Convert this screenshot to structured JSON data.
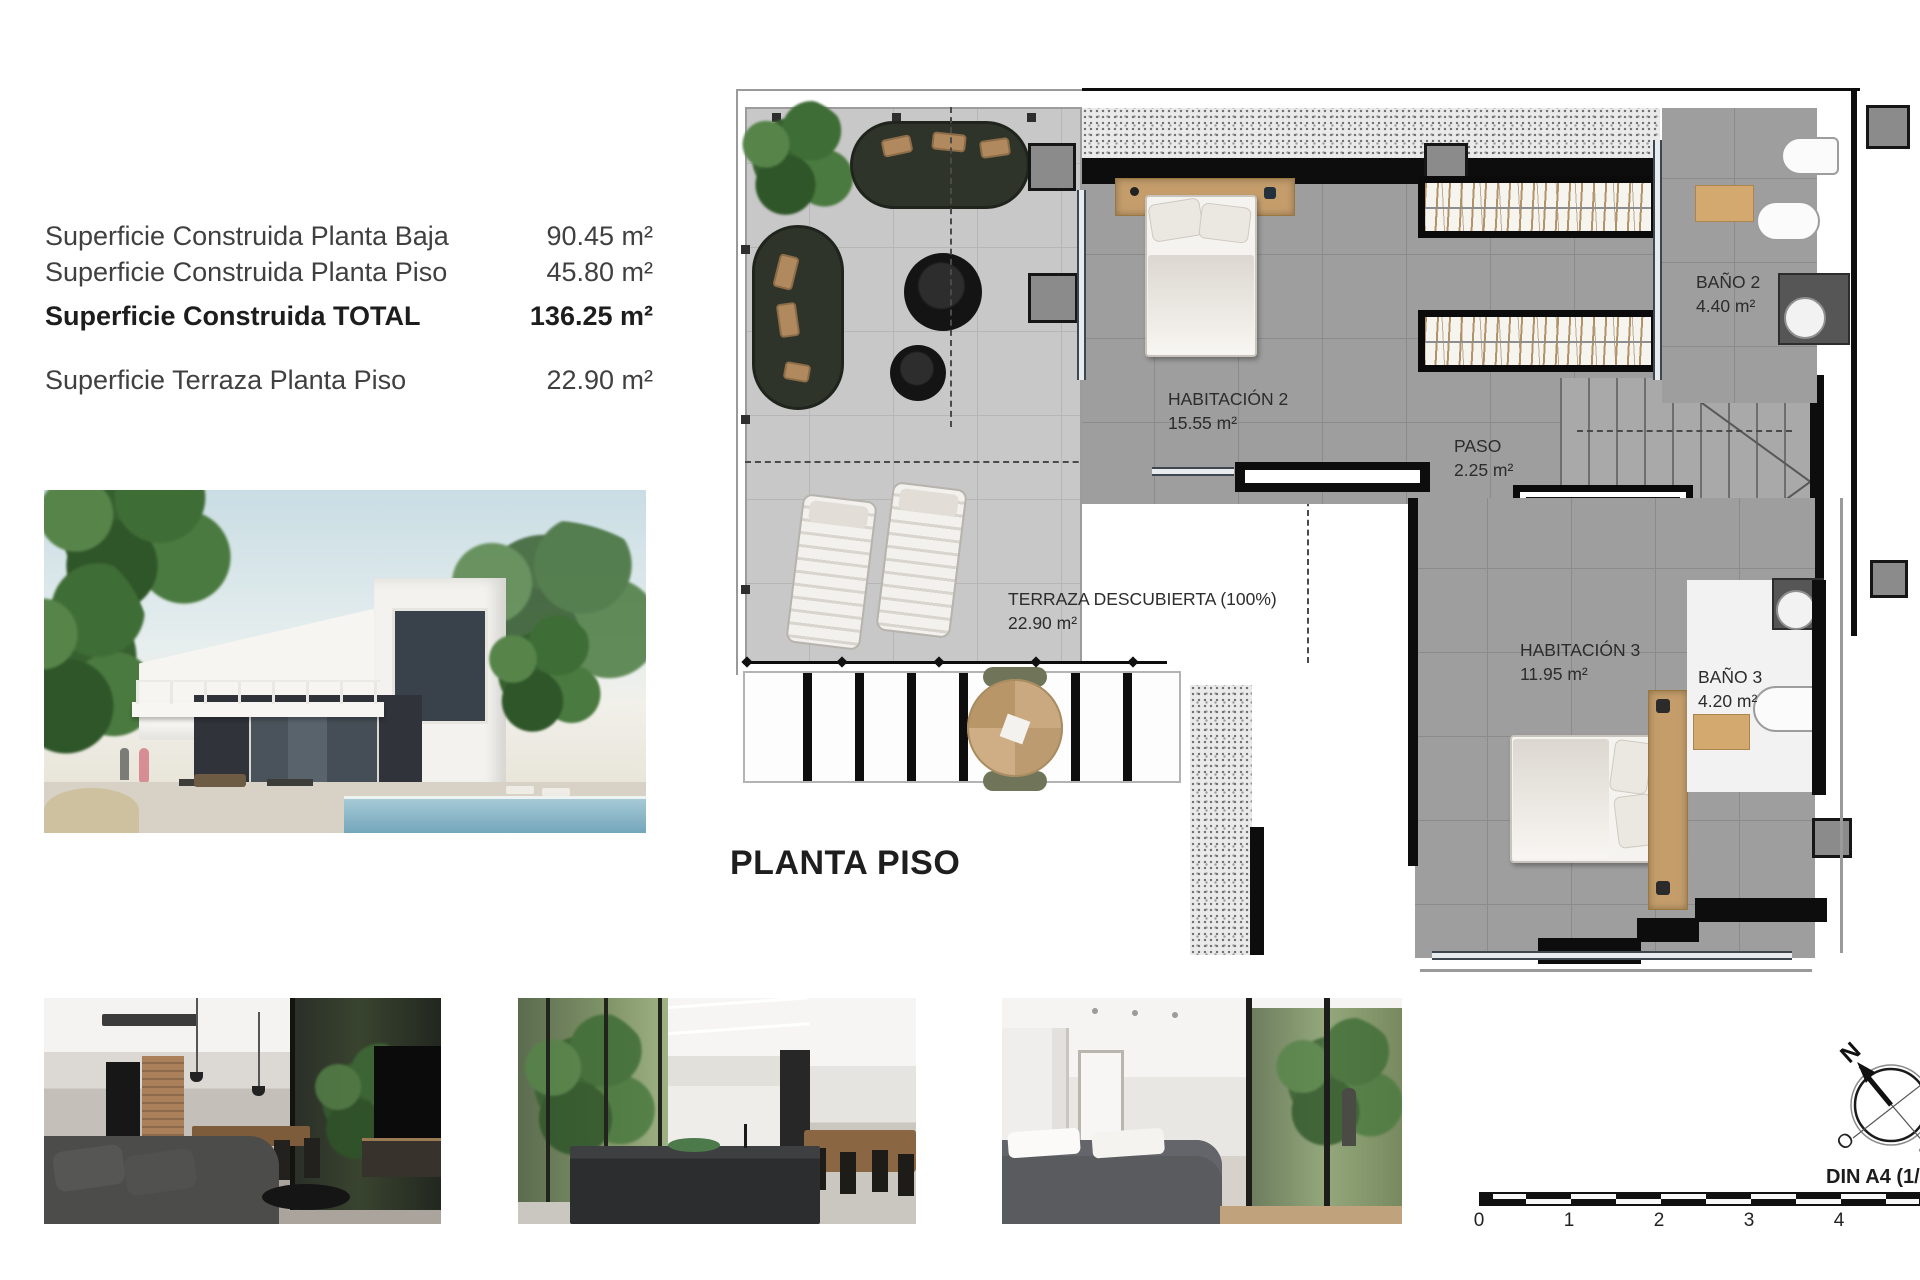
{
  "summary": {
    "rows": [
      {
        "label": "Superficie Construida Planta Baja",
        "value": "90.45 m²"
      },
      {
        "label": "Superficie Construida Planta Piso",
        "value": "45.80 m²"
      },
      {
        "label": "Superficie Construida TOTAL",
        "value": "136.25 m²"
      },
      {
        "label": "Superficie Terraza Planta Piso",
        "value": "22.90 m²"
      }
    ]
  },
  "plan": {
    "title": "PLANTA PISO",
    "rooms": {
      "habitacion2": {
        "name": "HABITACIÓN 2",
        "area": "15.55 m²"
      },
      "paso": {
        "name": "PASO",
        "area": "2.25 m²"
      },
      "bano2": {
        "name": "BAÑO 2",
        "area": "4.40 m²"
      },
      "habitacion3": {
        "name": "HABITACIÓN 3",
        "area": "11.95 m²"
      },
      "bano3": {
        "name": "BAÑO 3",
        "area": "4.20 m²"
      },
      "terraza": {
        "name": "TERRAZA DESCUBIERTA (100%)",
        "area": "22.90 m²"
      }
    }
  },
  "compass": {
    "n": "N",
    "e": "E",
    "s": "S",
    "o": "O"
  },
  "scale": {
    "ticks": [
      "0",
      "1",
      "2",
      "3",
      "4"
    ],
    "caption": "DIN A4 (1/75)"
  }
}
